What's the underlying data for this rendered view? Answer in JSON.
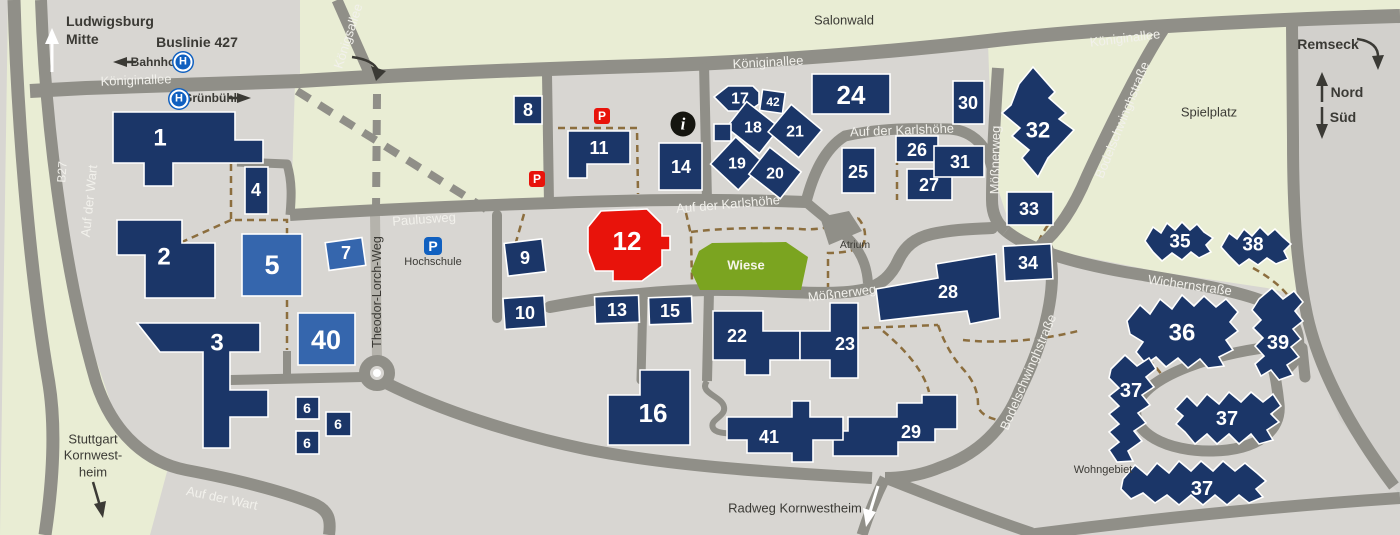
{
  "colors": {
    "building_navy": "#1b3668",
    "building_light": "#3566ad",
    "building_red": "#e8130b",
    "road": "#908f88",
    "road_minor": "#b5b3ac",
    "campus": "#d8d6d2",
    "field": "#e9edd4",
    "outside": "#d2d0cc",
    "meadow": "#7ba420",
    "path_brown": "#8c6e3e",
    "text_dark": "#3b3a35",
    "road_text": "#f2f1ec",
    "icon_blue": "#1060c0"
  },
  "transit": {
    "busline": "Buslinie 427",
    "stop_bahnhof": "Bahnhof",
    "stop_gruenbuehl": "Grünbühl",
    "stop_icon": "H"
  },
  "compass": {
    "north": "Nord",
    "south": "Süd"
  },
  "destinations": {
    "ludwigsburg_line1": "Ludwigsburg",
    "ludwigsburg_line2": "Mitte",
    "stuttgart_line1": "Stuttgart",
    "stuttgart_line2": "Kornwest-",
    "stuttgart_line3": "heim",
    "remseck": "Remseck",
    "radweg": "Radweg Kornwestheim"
  },
  "streets": {
    "koeniginallee": "Königinallee",
    "koenigsallee": "Königsallee",
    "b27": "B27",
    "auf_der_wart": "Auf der Wart",
    "paulusweg": "Paulusweg",
    "theodor_lorch_weg": "Theodor-Lorch-Weg",
    "auf_der_karlshoehe": "Auf der Karlshöhe",
    "moessnerweg": "Mößnerweg",
    "bodelschwinghstrasse": "Bodelschwinghstraße",
    "wichernstrasse": "Wichernstraße"
  },
  "areas": {
    "salonwald": "Salonwald",
    "spielplatz": "Spielplatz",
    "wiese": "Wiese",
    "atrium": "Atrium",
    "wohngebiet": "Wohngebiet",
    "hochschule": "Hochschule"
  },
  "icons": {
    "parking": "P",
    "info": "i"
  },
  "buildings": [
    {
      "key": "b1",
      "label": "1"
    },
    {
      "key": "b2",
      "label": "2"
    },
    {
      "key": "b3",
      "label": "3"
    },
    {
      "key": "b4",
      "label": "4"
    },
    {
      "key": "b5",
      "label": "5",
      "color": "light"
    },
    {
      "key": "b6a",
      "label": "6"
    },
    {
      "key": "b6b",
      "label": "6"
    },
    {
      "key": "b6c",
      "label": "6"
    },
    {
      "key": "b7",
      "label": "7",
      "color": "light"
    },
    {
      "key": "b8",
      "label": "8"
    },
    {
      "key": "b9",
      "label": "9"
    },
    {
      "key": "b10",
      "label": "10"
    },
    {
      "key": "b11",
      "label": "11"
    },
    {
      "key": "b12",
      "label": "12",
      "color": "red"
    },
    {
      "key": "b13",
      "label": "13"
    },
    {
      "key": "b14",
      "label": "14"
    },
    {
      "key": "b15",
      "label": "15"
    },
    {
      "key": "b16",
      "label": "16"
    },
    {
      "key": "b17",
      "label": "17"
    },
    {
      "key": "b18",
      "label": "18"
    },
    {
      "key": "b19",
      "label": "19"
    },
    {
      "key": "b20",
      "label": "20"
    },
    {
      "key": "b21",
      "label": "21"
    },
    {
      "key": "b22",
      "label": "22"
    },
    {
      "key": "b23",
      "label": "23"
    },
    {
      "key": "b24",
      "label": "24"
    },
    {
      "key": "b25",
      "label": "25"
    },
    {
      "key": "b26",
      "label": "26"
    },
    {
      "key": "b27",
      "label": "27"
    },
    {
      "key": "b28",
      "label": "28"
    },
    {
      "key": "b29",
      "label": "29"
    },
    {
      "key": "b30",
      "label": "30"
    },
    {
      "key": "b31",
      "label": "31"
    },
    {
      "key": "b32",
      "label": "32"
    },
    {
      "key": "b33",
      "label": "33"
    },
    {
      "key": "b34",
      "label": "34"
    },
    {
      "key": "b35",
      "label": "35"
    },
    {
      "key": "b36",
      "label": "36"
    },
    {
      "key": "b37a",
      "label": "37"
    },
    {
      "key": "b37b",
      "label": "37"
    },
    {
      "key": "b37c",
      "label": "37"
    },
    {
      "key": "b38",
      "label": "38"
    },
    {
      "key": "b39",
      "label": "39"
    },
    {
      "key": "b40",
      "label": "40",
      "color": "light"
    },
    {
      "key": "b41",
      "label": "41"
    },
    {
      "key": "b42",
      "label": "42"
    },
    {
      "key": "bsq",
      "label": ""
    }
  ]
}
